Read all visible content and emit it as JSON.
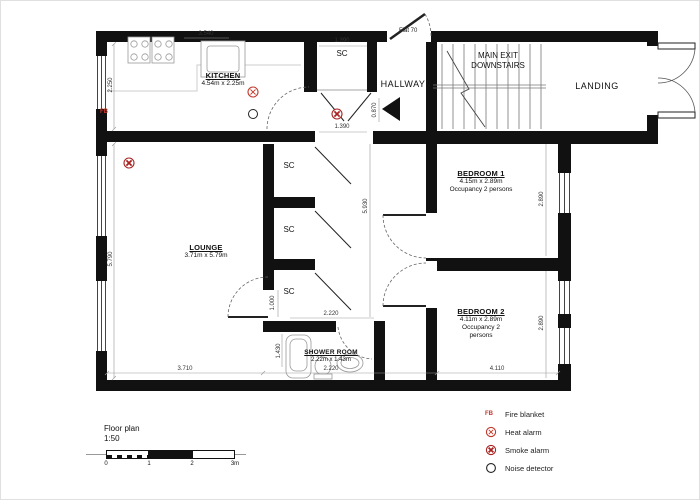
{
  "plan": {
    "rooms": {
      "kitchen": {
        "name": "KITCHEN",
        "size": "4.54m x 2.25m"
      },
      "hallway": {
        "name": "HALLWAY"
      },
      "stairs": {
        "line1": "MAIN EXIT",
        "line2": "DOWNSTAIRS"
      },
      "landing": {
        "name": "LANDING"
      },
      "lounge": {
        "name": "LOUNGE",
        "size": "3.71m x 5.79m"
      },
      "bedroom1": {
        "name": "BEDROOM 1",
        "size": "4.15m x 2.89m",
        "occupancy": "Occupancy 2 persons"
      },
      "bedroom2": {
        "name": "BEDROOM 2",
        "size": "4.11m x 2.89m",
        "occupancy1": "Occupancy 2",
        "occupancy2": "persons"
      },
      "shower": {
        "name": "SHOWER ROOM",
        "size": "2.22m x 1.43m"
      },
      "closet": "SC"
    },
    "entrance_label": "Flat 70",
    "fire_blanket_marker": "FB",
    "dims": {
      "kitchen_top": "3.540",
      "kitchen_left": "2.250",
      "lounge_left": "5.790",
      "sc_top": "1.390",
      "sc_bottom": "1.390",
      "hall": "0.870",
      "corridor": "5.930",
      "bedroom1_right": "2.890",
      "bedroom2_right": "2.890",
      "lounge_door": "1.000",
      "shower_top": "2.220",
      "shower_bottom": "2.220",
      "shower_left": "1.430",
      "lounge_bottom": "3.710",
      "bedroom2_bottom": "4.110"
    }
  },
  "legend": {
    "items": [
      {
        "symbol": "FB",
        "label": "Fire blanket"
      },
      {
        "symbol": "heat-alarm-icon",
        "label": "Heat alarm"
      },
      {
        "symbol": "smoke-alarm-icon",
        "label": "Smoke alarm"
      },
      {
        "symbol": "noise-detector-icon",
        "label": "Noise detector"
      }
    ]
  },
  "scale_bar": {
    "title": "Floor plan",
    "ratio": "1:50",
    "ticks": [
      "0",
      "1",
      "2",
      "3m"
    ]
  },
  "colors": {
    "alarm_red": "#c0392b",
    "wall_black": "#111111"
  }
}
